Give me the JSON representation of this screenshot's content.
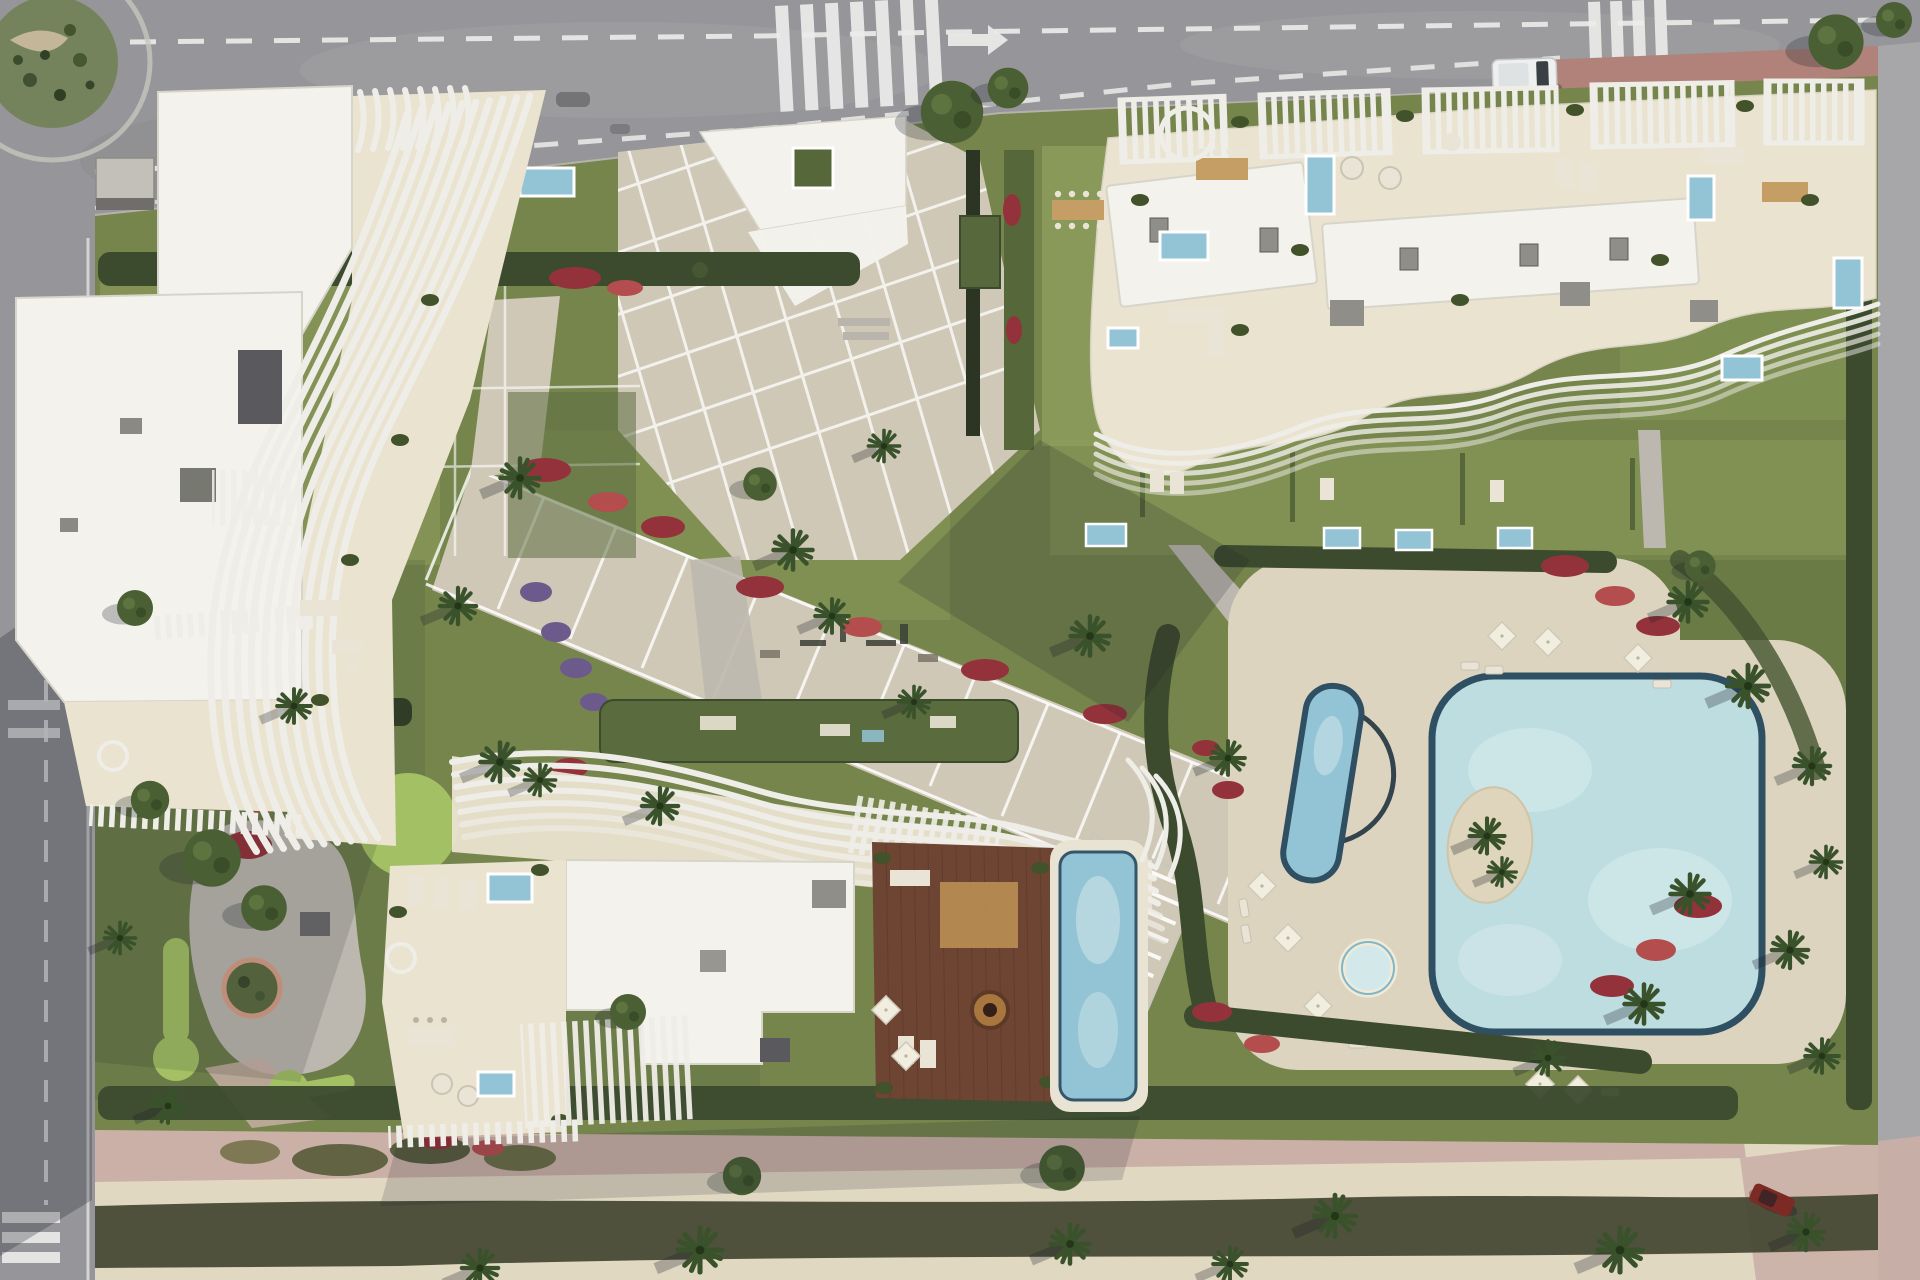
{
  "scene": {
    "kind": "aerial top-down 3D architectural rendering",
    "subject": "luxury residential resort complex with three sculptural white apartment buildings, landscaped gardens and pool club",
    "surroundings": {
      "top_road": {
        "type": "multi-lane avenue",
        "markings": [
          "dashed lane lines",
          "zebra crosswalk center-left",
          "zebra crosswalk right",
          "white right-turn arrow"
        ],
        "vehicles": [
          "white van parked near right crosswalk"
        ],
        "corner_paving": "reddish brick sidewalk at right intersection"
      },
      "left_road": {
        "type": "secondary street",
        "markings": [
          "dashed center line",
          "edge line",
          "give-way marks",
          "zebra crosswalk at bottom"
        ],
        "feature": "roundabout with cacti planting island at top-left corner"
      },
      "right_road": {
        "type": "narrow side street",
        "feature": "pink paved corner with dark-red parked car at bottom-right"
      },
      "bottom_promenade": {
        "type": "beach promenade",
        "features": [
          "pink footpath",
          "sand strip",
          "continuous hedge row casting shadow",
          "scattered palm trees"
        ]
      }
    },
    "buildings": [
      {
        "id": "building-west",
        "position": "top-left",
        "style": "white organic tower, flat white roof, sweeping curved louver fins on east facade, cream terraces, rooftop boxes"
      },
      {
        "id": "building-north-east",
        "position": "top-right",
        "style": "long cream roof-terrace slab with slatted pergolas, two white roof slabs, private jacuzzi pools, lounge furniture, wavy louver south edge, private lawn gardens with plunge pools below"
      },
      {
        "id": "building-south",
        "position": "bottom-center",
        "style": "wavy louver crown, white roof, cream west terrace, brown timber rooftop deck with fire-pit lounge, large rooftop infinity pool, white slat fences"
      }
    ],
    "pools": [
      {
        "id": "lagoon-pool",
        "shape": "large rounded-square lagoon",
        "feature": "interior sand island with palms"
      },
      {
        "id": "lap-pool",
        "shape": "angled rectangular lane pool beside oval sun-deck"
      },
      {
        "id": "kids-round-pool",
        "shape": "small circular pool on deck"
      },
      {
        "id": "rooftop-infinity-pool",
        "location": "south building rooftop"
      },
      {
        "id": "plunge-pools",
        "count": 10,
        "location": "terraces and private gardens"
      }
    ],
    "amenities": [
      "entrance plaza with white canopies and grid paving",
      "diagonal boulevard walkway with cross stripes",
      "stepped garden stair ramp",
      "mini-golf putting greens",
      "outdoor gym corner",
      "green-roof pavilion with lounge",
      "sun loungers",
      "white parasols",
      "circular planter"
    ],
    "vegetation": [
      "lawns",
      "clipped dark hedges",
      "red bougainvillea masses",
      "purple flower beds",
      "palm trees with long shadows",
      "round olive-green trees",
      "cacti on roundabout island"
    ]
  },
  "palette": {
    "asphalt": "#96969a",
    "asphaltLight": "#a7a6a8",
    "roadMark": "#ececea",
    "sidewalk": "#b6b2ab",
    "brickPaving": "#b0827a",
    "roundaboutGreen": "#75835d",
    "lawn": "#75854c",
    "lawnLight": "#8d9d5c",
    "lawnDark": "#5d6e41",
    "puttingGreen": "#a3c164",
    "hedge": "#3c4b2e",
    "hedgeMid": "#566739",
    "flowerRed": "#94323b",
    "flowerRedLight": "#b44d4d",
    "flowerPurple": "#6d5a8c",
    "pathBeige": "#cfc8b6",
    "pathLight": "#ded8c6",
    "pathGray": "#bcb8af",
    "deckBeige": "#dcd4bf",
    "poolRim": "#2f4f63",
    "poolWater": "#93c4d6",
    "poolLagoon": "#bddde0",
    "poolLight": "#d3e8e9",
    "sandIsland": "#ded5bc",
    "roofWhite": "#f3f2ec",
    "roofShadow": "#d7d5ca",
    "terraceCream": "#eae3d0",
    "louver": "#efede7",
    "woodDeck": "#6e4433",
    "woodDark": "#57352a",
    "boxGray": "#8f8e88",
    "boxDark": "#5a5a5e",
    "sand": "#e1d8c2",
    "pinkPath": "#cbb0a7",
    "darkHedgeBand": "#454833",
    "shadow": "rgba(25,30,40,0.30)",
    "furniture": "#e9e4d5",
    "tableTan": "#c59e66",
    "vanWhite": "#eef0f0",
    "carRed": "#7c2a24"
  }
}
